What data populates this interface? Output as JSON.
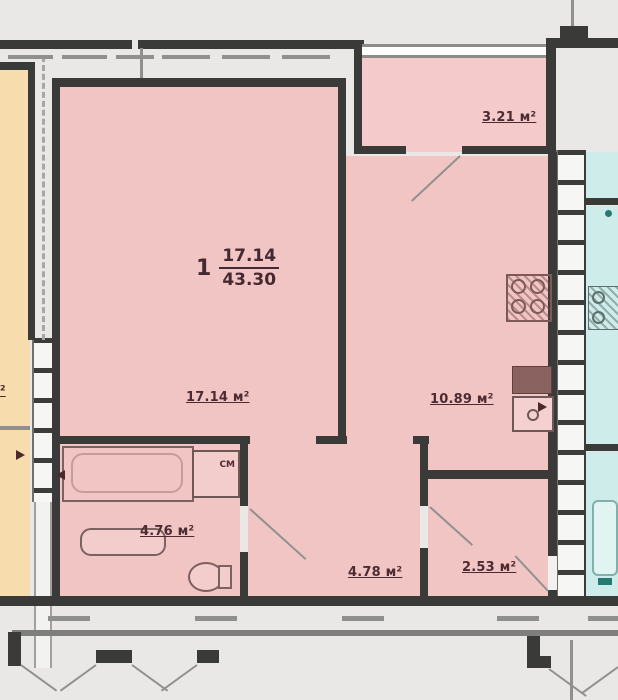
{
  "plan": {
    "unit": {
      "number": "1",
      "living_area": "17.14",
      "total_area": "43.30"
    },
    "rooms": {
      "living": "17.14 м²",
      "kitchen": "10.89 м²",
      "balcony": "3.21 м²",
      "bathroom": "4.76 м²",
      "corridor": "4.78 м²",
      "hallway": "2.53 м²",
      "neighbor_left_partial": "м²"
    },
    "fixtures": {
      "washing_machine_label": "СМ"
    },
    "colors": {
      "apartment_fill": "#f2c5c5",
      "balcony_fill": "#f4caca",
      "neighbor_left_fill": "#f7ddad",
      "neighbor_right_fill": "#cdecea",
      "wall": "#3a3a38",
      "background": "#e9e8e6",
      "label_text": "#4e2b31"
    }
  }
}
